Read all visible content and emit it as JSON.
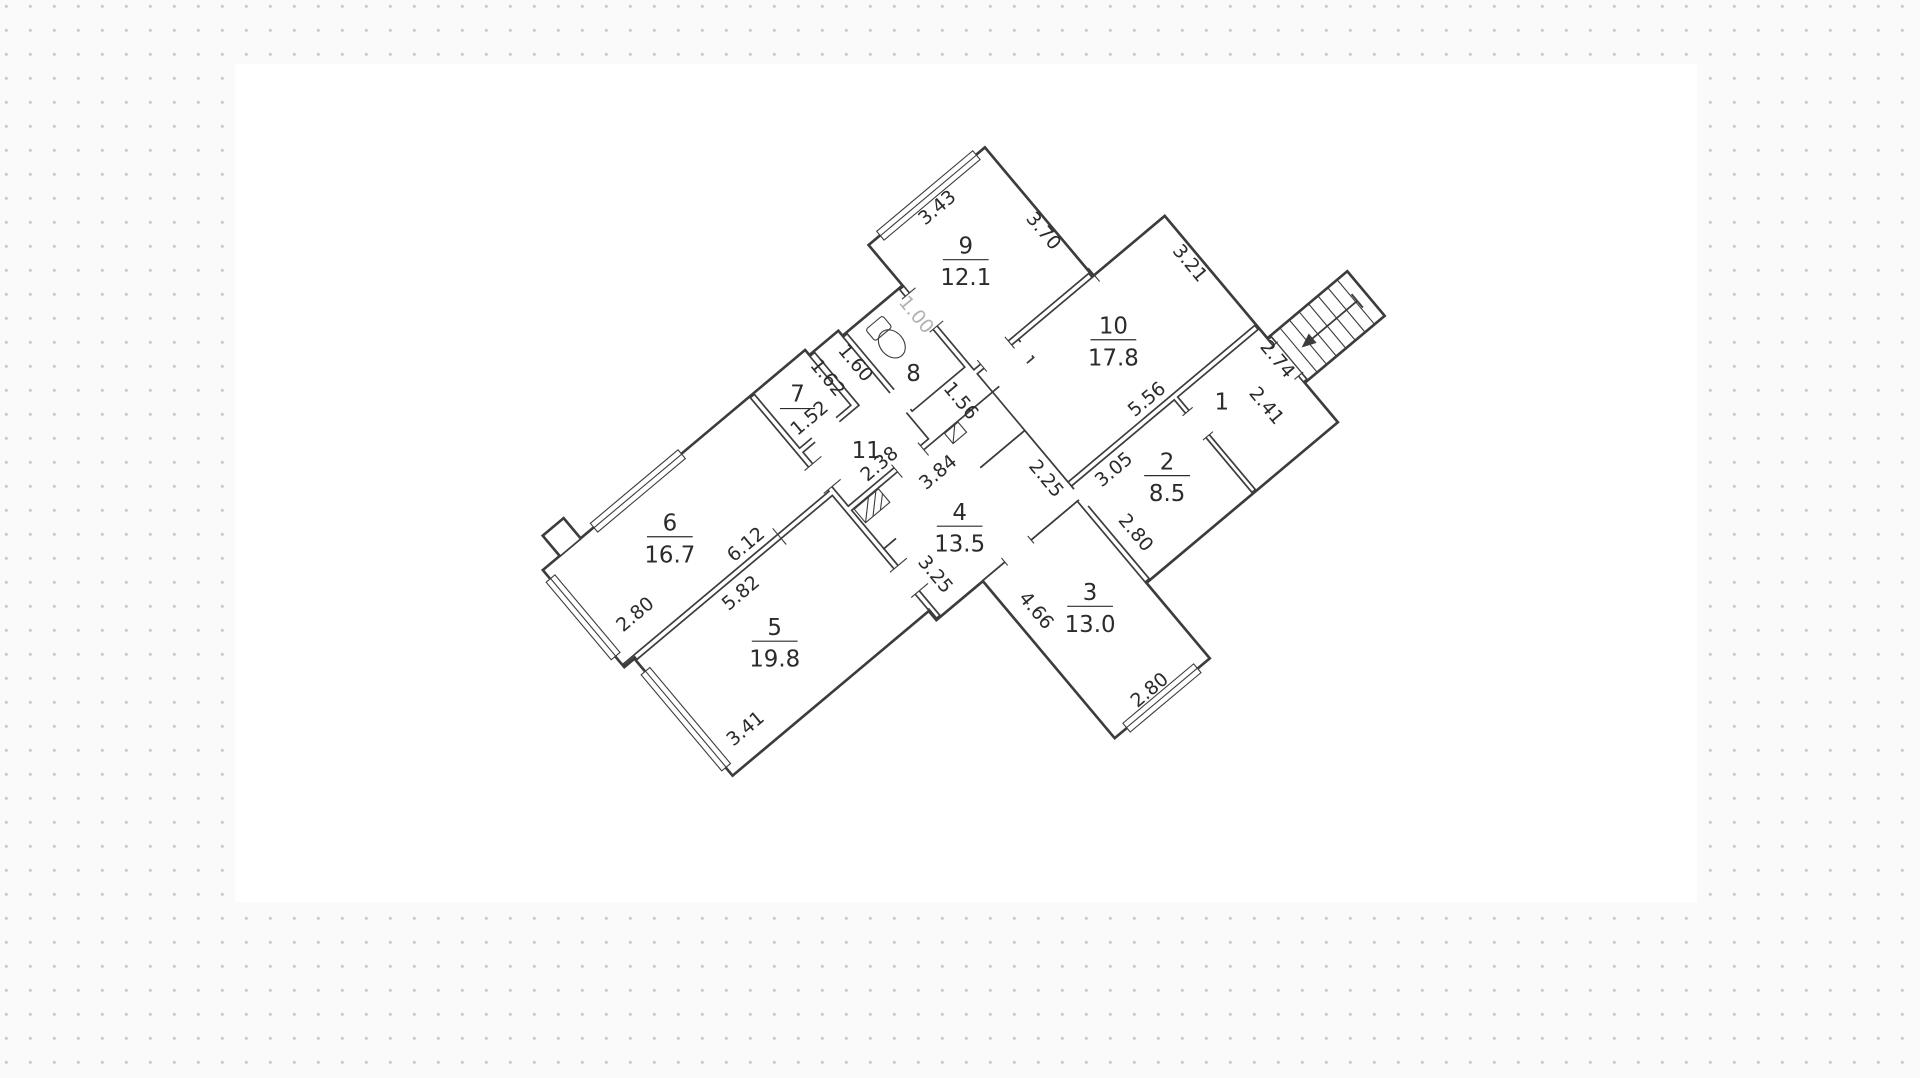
{
  "canvas": {
    "background": "#fafafa",
    "dot_color": "#c9c9c9",
    "paper_color": "#ffffff",
    "wall_color": "#3c3c3c",
    "faded_dim_color": "#b3b3b3"
  },
  "rooms": {
    "r1": {
      "number": "1"
    },
    "r2": {
      "number": "2",
      "area": "8.5"
    },
    "r3": {
      "number": "3",
      "area": "13.0"
    },
    "r4": {
      "number": "4",
      "area": "13.5"
    },
    "r5": {
      "number": "5",
      "area": "19.8"
    },
    "r6": {
      "number": "6",
      "area": "16.7"
    },
    "r7": {
      "number": "7"
    },
    "r8": {
      "number": "8"
    },
    "r9": {
      "number": "9",
      "area": "12.1"
    },
    "r10": {
      "number": "10",
      "area": "17.8"
    },
    "r11": {
      "number": "11"
    }
  },
  "dims": {
    "d152": "1.52",
    "d162": "1.62",
    "d160": "1.60",
    "d238": "2.38",
    "d612": "6.12",
    "d582": "5.82",
    "d280a": "2.80",
    "d341": "3.41",
    "d384": "3.84",
    "d100": "1.00",
    "d156": "1.56",
    "d343": "3.43",
    "d370": "3.70",
    "d321": "3.21",
    "d556": "5.56",
    "d325": "3.25",
    "d225": "2.25",
    "d305": "3.05",
    "d280b": "2.80",
    "d280c": "2.80",
    "d466": "4.66",
    "d241": "2.41",
    "d274": "2.74"
  }
}
